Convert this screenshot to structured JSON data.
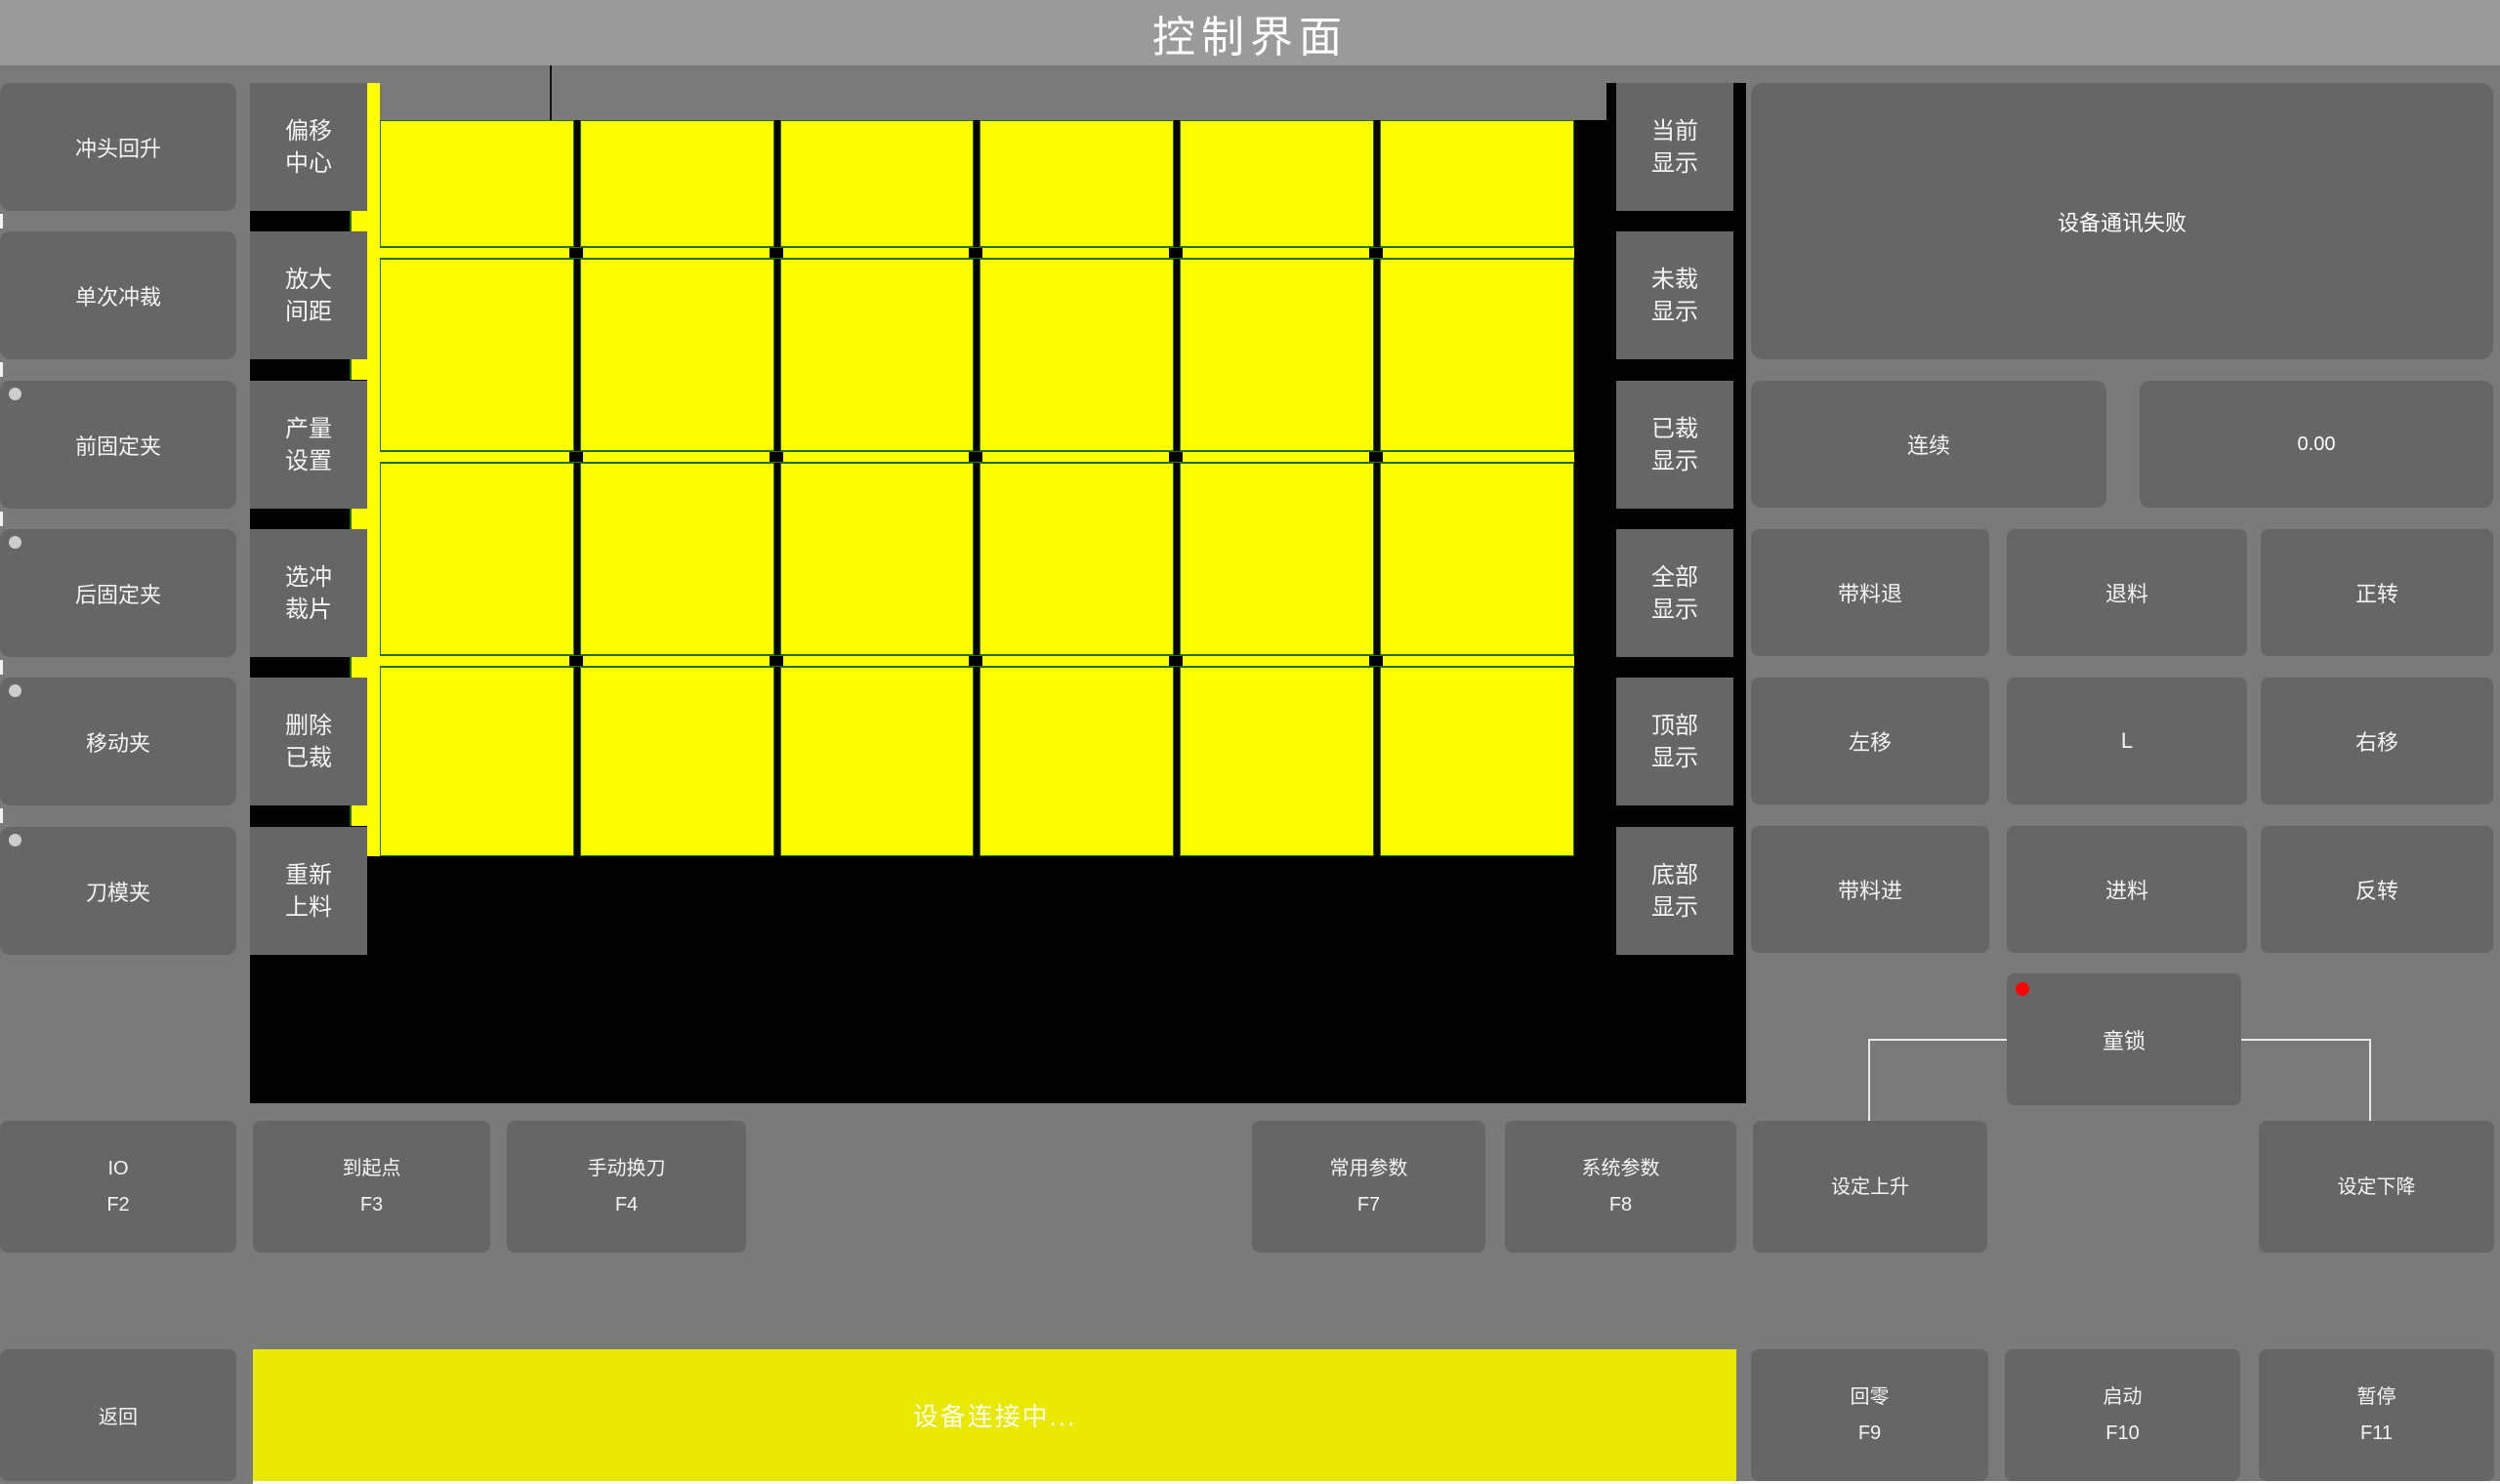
{
  "title": "控制界面",
  "left_buttons": [
    {
      "label": "冲头回升",
      "led": false
    },
    {
      "label": "单次冲裁",
      "led": false
    },
    {
      "label": "前固定夹",
      "led": true
    },
    {
      "label": "后固定夹",
      "led": true
    },
    {
      "label": "移动夹",
      "led": true
    },
    {
      "label": "刀模夹",
      "led": true
    }
  ],
  "tool_buttons": [
    {
      "line1": "偏移",
      "line2": "中心"
    },
    {
      "line1": "放大",
      "line2": "间距"
    },
    {
      "line1": "产量",
      "line2": "设置"
    },
    {
      "line1": "选冲",
      "line2": "裁片"
    },
    {
      "line1": "删除",
      "line2": "已裁"
    },
    {
      "line1": "重新",
      "line2": "上料"
    }
  ],
  "display_buttons": [
    {
      "line1": "当前",
      "line2": "显示"
    },
    {
      "line1": "未裁",
      "line2": "显示"
    },
    {
      "line1": "已裁",
      "line2": "显示"
    },
    {
      "line1": "全部",
      "line2": "显示"
    },
    {
      "line1": "顶部",
      "line2": "显示"
    },
    {
      "line1": "底部",
      "line2": "显示"
    }
  ],
  "nesting_view": {
    "rows": 4,
    "cols": 6,
    "piece_color": "#ffff00",
    "piece_outline_color": "#267000",
    "background_color": "#000000"
  },
  "right_panel": {
    "message": "设备通讯失败",
    "continuous_label": "连续",
    "value": "0.00",
    "motion_grid": [
      [
        "带料退",
        "退料",
        "正转"
      ],
      [
        "左移",
        "L",
        "右移"
      ],
      [
        "带料进",
        "进料",
        "反转"
      ]
    ],
    "child_lock_label": "童锁",
    "child_lock_indicator_color": "#ff0000"
  },
  "function_row": [
    {
      "label": "IO",
      "fkey": "F2"
    },
    {
      "label": "到起点",
      "fkey": "F3"
    },
    {
      "label": "手动换刀",
      "fkey": "F4"
    },
    {
      "label": "常用参数",
      "fkey": "F7"
    },
    {
      "label": "系统参数",
      "fkey": "F8"
    },
    {
      "label": "设定上升",
      "fkey": ""
    },
    {
      "label": "设定下降",
      "fkey": ""
    }
  ],
  "bottom_bar": {
    "back_label": "返回",
    "status_text": "设备连接中...",
    "status_bar_color": "#e8e800",
    "fkey_buttons": [
      {
        "label": "回零",
        "fkey": "F9"
      },
      {
        "label": "启动",
        "fkey": "F10"
      },
      {
        "label": "暂停",
        "fkey": "F11"
      }
    ]
  },
  "colors": {
    "background": "#7a7a7a",
    "titlebar": "#9a9a9a",
    "button": "#666666",
    "grid_yellow": "#ffff00",
    "grid_green": "#267000",
    "status_yellow": "#e8e800",
    "alert_red": "#ff0000"
  }
}
